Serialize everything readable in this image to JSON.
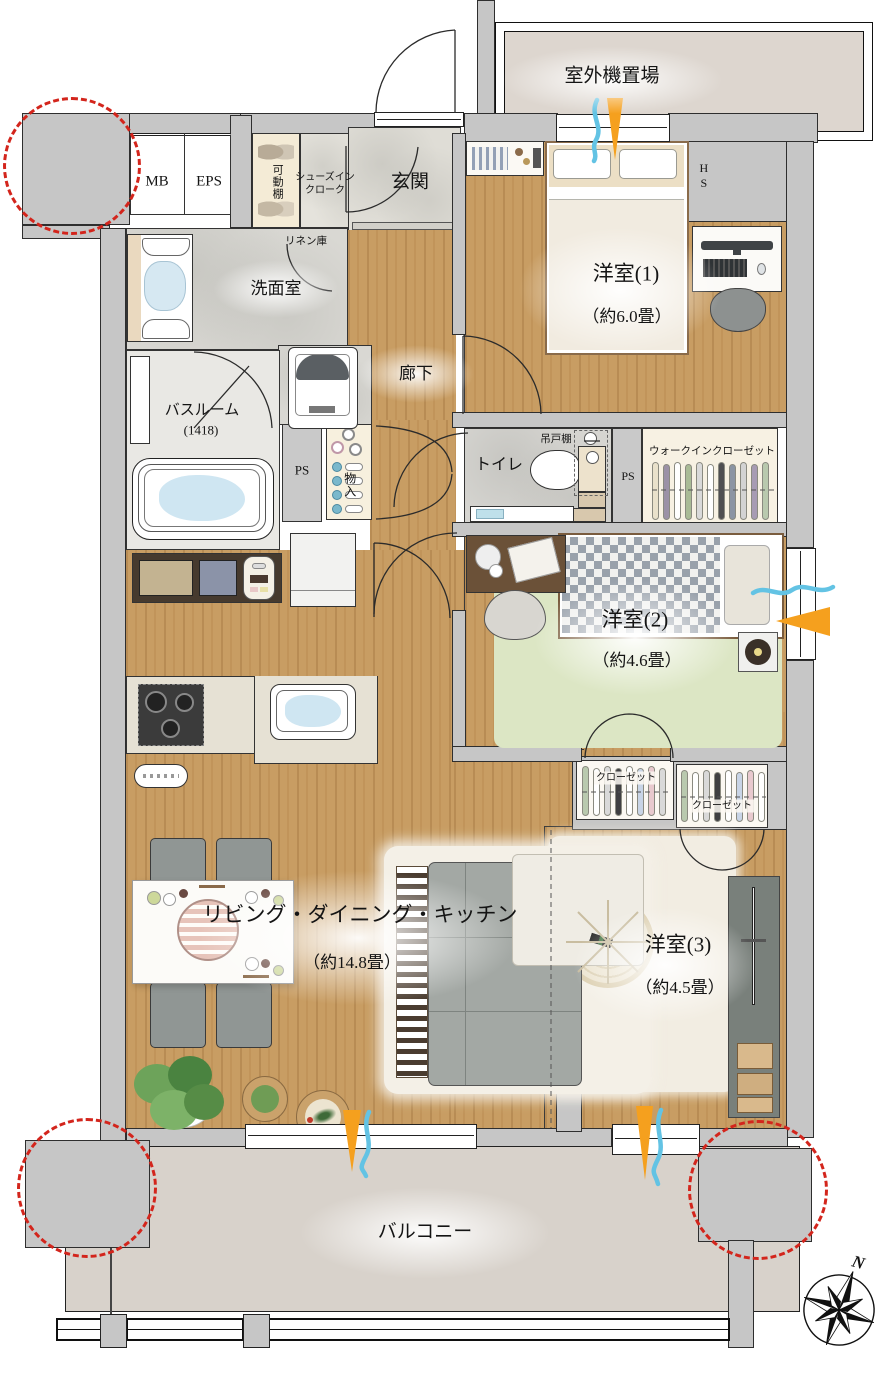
{
  "title": "マンション間取り図",
  "labels": {
    "outdoor_unit": "室外機置場",
    "mb": "MB",
    "eps": "EPS",
    "movable_shelf": "可動棚",
    "shoes_in_closet": "シューズイン\nクローク",
    "entrance": "玄関",
    "linen_storage": "リネン庫",
    "washroom": "洗面室",
    "bathroom": "バスルーム",
    "bathroom_size": "(1418)",
    "corridor": "廊下",
    "ps_left": "PS",
    "ps_right": "PS",
    "storage": "物入",
    "toilet": "トイレ",
    "hanging_cupboard": "吊戸棚",
    "walk_in_closet": "ウォークインクローゼット",
    "hs": "HS",
    "room1": "洋室(1)",
    "room1_size": "（約6.0畳）",
    "room2": "洋室(2)",
    "room2_size": "（約4.6畳）",
    "room3": "洋室(3)",
    "room3_size": "（約4.5畳）",
    "closet1": "クローゼット",
    "closet2": "クローゼット",
    "ldk": "リビング・ダイニング・キッチン",
    "ldk_size": "（約14.8畳）",
    "balcony": "バルコニー",
    "compass_north": "N"
  },
  "colors": {
    "wall_gray": "#c6c6c6",
    "wood_floor": "#c89d63",
    "stone_floor": "#d9d8d3",
    "balcony_floor": "#d8d2cb",
    "rug_green": "#dce6c4",
    "rug_cream": "#f2ede2",
    "accent_red_dashed": "#d3251c",
    "airflow_orange": "#f5a01e",
    "airflow_blue": "#63c3e4"
  }
}
